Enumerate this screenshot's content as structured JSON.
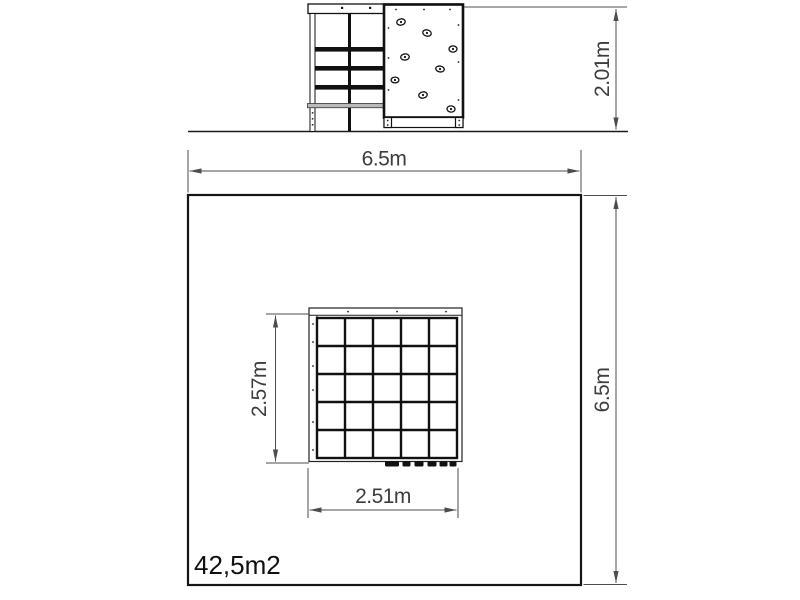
{
  "drawing": {
    "elevation_view": {
      "height_dimension_label": "2.01m"
    },
    "plan_view": {
      "site_width_dimension_label": "6.5m",
      "site_depth_dimension_label": "6.5m",
      "equipment_depth_dimension_label": "2.57m",
      "equipment_width_dimension_label": "2.51m",
      "area_label": "42,5m2"
    },
    "colors": {
      "structure_line": "#1a1a1a",
      "dimension_line": "#4d4d4d",
      "dimension_text": "#3d3d3d",
      "area_text": "#101010",
      "background": "#ffffff",
      "gray_rail": "#b9b9b9"
    }
  }
}
